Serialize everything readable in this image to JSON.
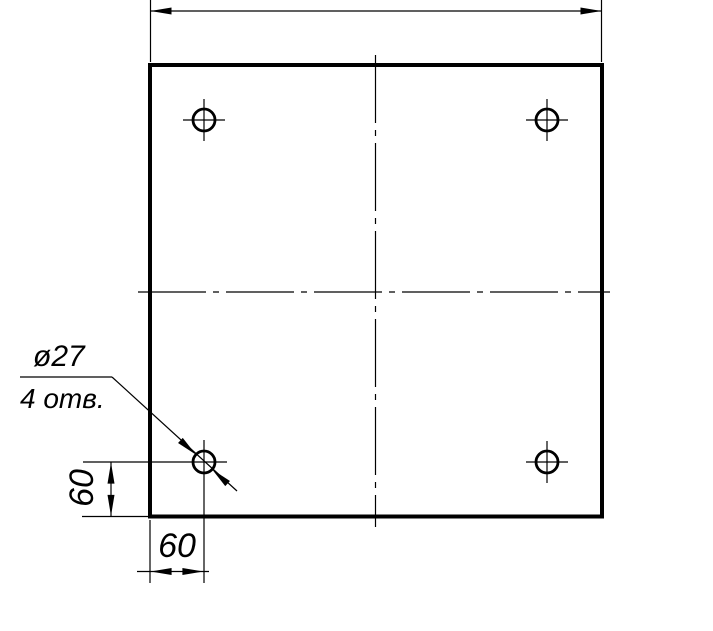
{
  "page": {
    "kind": "engineering-drawing",
    "description": "square plate, four drilled holes, GOST-style dimensioning",
    "colors": {
      "line": "#000000",
      "background": "#ffffff"
    }
  },
  "drawing": {
    "callout": {
      "line1": "ø27",
      "line2": "4 отв."
    },
    "dims": {
      "left_offset": "60",
      "bottom_offset": "60"
    },
    "holes": {
      "count": 4,
      "diameter_label": "ø27"
    }
  }
}
